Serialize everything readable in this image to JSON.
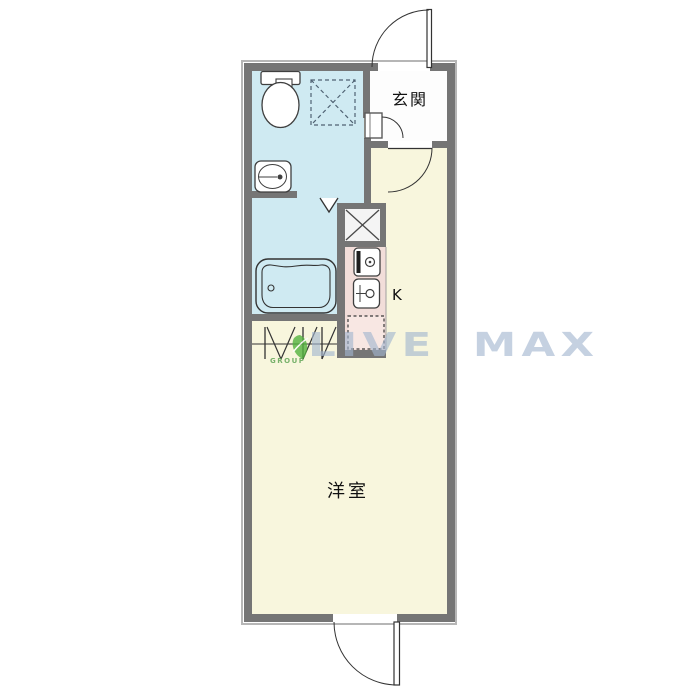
{
  "floorplan": {
    "labels": {
      "entrance": "玄関",
      "kitchen": "K",
      "western_room": "洋室"
    },
    "watermark": {
      "brand": "LIVE MAX",
      "group": "GROUP"
    },
    "colors": {
      "wall": "#757575",
      "bathroom_floor": "#cfeaf2",
      "room_floor": "#f8f6dd",
      "kitchen_floor": "#f2ddd9",
      "entrance_floor": "#fdfdfd",
      "refrigerator_space_fill": "#f8e7e3",
      "watermark_text": "#a2b4ce",
      "logo_green": "#54b33f"
    },
    "symbols": [
      "toilet",
      "washbasin",
      "bathtub",
      "bathroom-folding-door",
      "washing-machine-space",
      "pipe-space",
      "stove",
      "kitchen-sink",
      "refrigerator-space",
      "closet-folding-door",
      "entrance-door",
      "bathroom-door",
      "hall-door",
      "room-exit-door"
    ]
  }
}
